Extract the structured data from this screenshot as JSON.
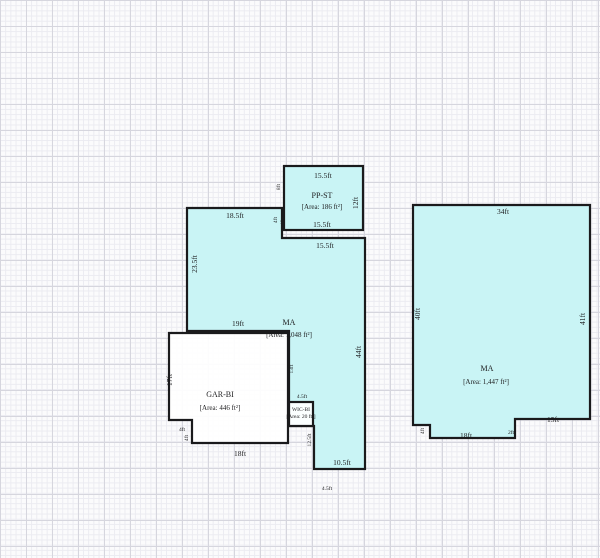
{
  "colors": {
    "room_fill": "#c9f4f5",
    "wall": "#1a1a1c",
    "text": "#1c1c1e"
  },
  "rooms": {
    "pp_st": {
      "name": "PP-ST",
      "area": "[Area: 186 ft²]"
    },
    "ma_left": {
      "name": "MA",
      "area": "[Area: 1,048 ft²]"
    },
    "gar_bi": {
      "name": "GAR-BI",
      "area": "[Area: 446 ft²]"
    },
    "closet": {
      "name": "WIC-BI",
      "area": "[Area: 20 ft²]"
    },
    "ma_right": {
      "name": "MA",
      "area": "[Area: 1,447 ft²]"
    }
  },
  "dimensions": {
    "pp_top": "15.5ft",
    "pp_bottom": "15.5ft",
    "pp_right": "12ft",
    "pp_left": "8ft",
    "pp_joint_a": "4ft",
    "pp_joint_b": "4ft",
    "ma_top": "18.5ft",
    "ma_top_right": "15.5ft",
    "ma_left": "23.5ft",
    "ma_inner": "19ft",
    "ma_right": "44ft",
    "ma_gar_edge": "13ft",
    "closet_top": "4.5ft",
    "stub_left": "12.5ft",
    "stub_bottom": "10.5ft",
    "below_stub": "4.5ft",
    "gar_left": "17ft",
    "gar_bottom": "18ft",
    "gar_notch_w": "4ft",
    "gar_notch_h": "4ft",
    "r_top": "34ft",
    "r_left": "40ft",
    "r_right": "41ft",
    "r_bottom_right": "15ft",
    "r_bottom": "18ft",
    "r_notch": "4ft",
    "r_step": "2ft"
  }
}
